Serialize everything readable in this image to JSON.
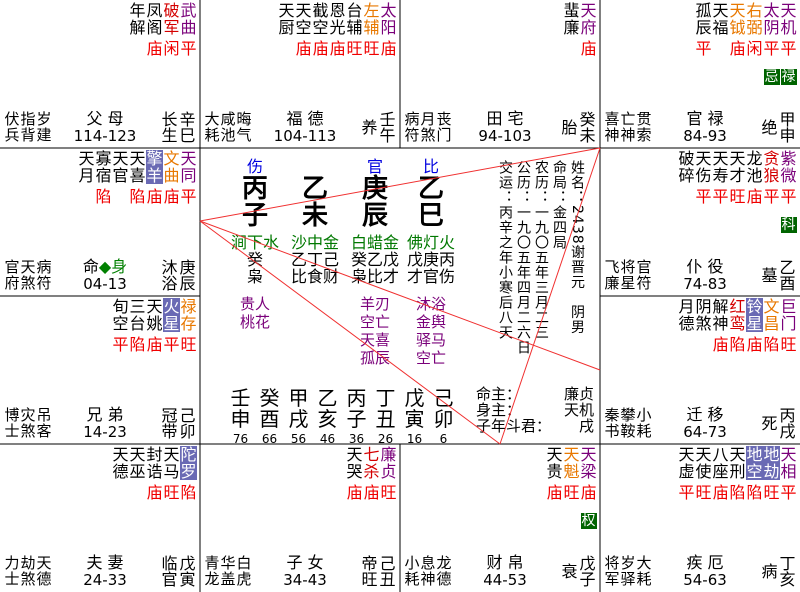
{
  "app_title": "紫微斗数命盘",
  "colors": {
    "major_star": "#7a007a",
    "red_star": "#d40000",
    "lucky_star": "#e87800",
    "malefic_badge_bg": "#6a6ab4",
    "transform_badge_bg": "#006400",
    "brightness": "#f00000",
    "nayin_green": "#007800",
    "ten_god_blue": "#0000e0",
    "note_purple": "#7a007a",
    "sanfang_line": "#f03030"
  },
  "palaces": [
    {
      "x": 0,
      "y": 0,
      "stars": [
        {
          "t": "年解",
          "c": "k",
          "s": "",
          "g": ""
        },
        {
          "t": "凤阁",
          "c": "k",
          "s": "庙",
          "g": ""
        },
        {
          "t": "破军",
          "c": "r",
          "s": "闲",
          "g": ""
        },
        {
          "t": "武曲",
          "c": "p",
          "s": "平",
          "g": ""
        }
      ],
      "petty": [
        "伏兵",
        "指背",
        "岁建"
      ],
      "palace": "父 母",
      "range": "114-123",
      "stage": "长生",
      "gz": "辛巳"
    },
    {
      "x": 200,
      "y": 0,
      "stars": [
        {
          "t": "天厨",
          "c": "k",
          "s": "",
          "g": ""
        },
        {
          "t": "天空",
          "c": "k",
          "s": "庙",
          "g": ""
        },
        {
          "t": "截空",
          "c": "k",
          "s": "庙",
          "g": ""
        },
        {
          "t": "恩光",
          "c": "k",
          "s": "庙",
          "g": ""
        },
        {
          "t": "台辅",
          "c": "k",
          "s": "旺",
          "g": ""
        },
        {
          "t": "左辅",
          "c": "o",
          "s": "旺",
          "g": ""
        },
        {
          "t": "太阳",
          "c": "p",
          "s": "庙",
          "g": ""
        }
      ],
      "petty": [
        "大耗",
        "咸池",
        "晦气"
      ],
      "palace": "福 德",
      "range": "104-113",
      "stage": "养",
      "gz": "壬午"
    },
    {
      "x": 400,
      "y": 0,
      "stars": [
        {
          "t": "蜚廉",
          "c": "k",
          "s": "",
          "g": ""
        },
        {
          "t": "天府",
          "c": "p",
          "s": "庙",
          "g": ""
        }
      ],
      "petty": [
        "病符",
        "月煞",
        "丧门"
      ],
      "palace": "田 宅",
      "range": "94-103",
      "stage": "胎",
      "gz": "癸未"
    },
    {
      "x": 600,
      "y": 0,
      "stars": [
        {
          "t": "孤辰",
          "c": "k",
          "s": "平",
          "g": ""
        },
        {
          "t": "天福",
          "c": "k",
          "s": "",
          "g": ""
        },
        {
          "t": "天钺",
          "c": "o",
          "s": "庙",
          "g": ""
        },
        {
          "t": "右弼",
          "c": "o",
          "s": "闲",
          "g": ""
        },
        {
          "t": "太阴",
          "c": "p",
          "s": "平",
          "g": "忌"
        },
        {
          "t": "天机",
          "c": "p",
          "s": "平",
          "g": "禄"
        }
      ],
      "petty": [
        "喜神",
        "亡神",
        "贯索"
      ],
      "palace": "官 禄",
      "range": "84-93",
      "stage": "绝",
      "gz": "甲申"
    },
    {
      "x": 0,
      "y": 148,
      "stars": [
        {
          "t": "天月",
          "c": "k",
          "s": "",
          "g": ""
        },
        {
          "t": "寡宿",
          "c": "k",
          "s": "陷",
          "g": ""
        },
        {
          "t": "天官",
          "c": "k",
          "s": "",
          "g": ""
        },
        {
          "t": "天喜",
          "c": "k",
          "s": "陷",
          "g": ""
        },
        {
          "t": "擎羊",
          "c": "b",
          "s": "庙",
          "g": ""
        },
        {
          "t": "文曲",
          "c": "o",
          "s": "庙",
          "g": ""
        },
        {
          "t": "天同",
          "c": "p",
          "s": "平",
          "g": ""
        }
      ],
      "petty": [
        "官府",
        "天煞",
        "病符"
      ],
      "palace": "命◆身",
      "palace_parts": [
        {
          "t": "命",
          "grn": false
        },
        {
          "t": "◆身",
          "grn": true
        }
      ],
      "range": "04-13",
      "stage": "沐浴",
      "gz": "庚辰"
    },
    {
      "x": 600,
      "y": 148,
      "stars": [
        {
          "t": "破碎",
          "c": "k",
          "s": "",
          "g": ""
        },
        {
          "t": "天伤",
          "c": "k",
          "s": "平",
          "g": ""
        },
        {
          "t": "天寿",
          "c": "k",
          "s": "平",
          "g": ""
        },
        {
          "t": "天才",
          "c": "k",
          "s": "旺",
          "g": ""
        },
        {
          "t": "龙池",
          "c": "k",
          "s": "庙",
          "g": ""
        },
        {
          "t": "贪狼",
          "c": "r",
          "s": "平",
          "g": ""
        },
        {
          "t": "紫微",
          "c": "p",
          "s": "平",
          "g": "科"
        }
      ],
      "petty": [
        "飞廉",
        "将星",
        "官符"
      ],
      "palace": "仆 役",
      "range": "74-83",
      "stage": "墓",
      "gz": "乙酉"
    },
    {
      "x": 0,
      "y": 296,
      "stars": [
        {
          "t": "旬空",
          "c": "k",
          "s": "平",
          "g": ""
        },
        {
          "t": "三台",
          "c": "k",
          "s": "陷",
          "g": ""
        },
        {
          "t": "天姚",
          "c": "k",
          "s": "庙",
          "g": ""
        },
        {
          "t": "火星",
          "c": "b",
          "s": "平",
          "g": ""
        },
        {
          "t": "禄存",
          "c": "o",
          "s": "旺",
          "g": ""
        }
      ],
      "petty": [
        "博士",
        "灾煞",
        "吊客"
      ],
      "palace": "兄 弟",
      "range": "14-23",
      "stage": "冠带",
      "gz": "己卯"
    },
    {
      "x": 600,
      "y": 296,
      "stars": [
        {
          "t": "月德",
          "c": "k",
          "s": "",
          "g": ""
        },
        {
          "t": "阴煞",
          "c": "k",
          "s": "",
          "g": ""
        },
        {
          "t": "解神",
          "c": "k",
          "s": "庙",
          "g": ""
        },
        {
          "t": "红鸾",
          "c": "r",
          "s": "陷",
          "g": ""
        },
        {
          "t": "铃星",
          "c": "b",
          "s": "庙",
          "g": ""
        },
        {
          "t": "文昌",
          "c": "o",
          "s": "陷",
          "g": ""
        },
        {
          "t": "巨门",
          "c": "p",
          "s": "旺",
          "g": ""
        }
      ],
      "petty": [
        "秦书",
        "攀鞍",
        "小耗"
      ],
      "palace": "迁 移",
      "range": "64-73",
      "stage": "死",
      "gz": "丙戌"
    },
    {
      "x": 0,
      "y": 444,
      "stars": [
        {
          "t": "天德",
          "c": "k",
          "s": "",
          "g": ""
        },
        {
          "t": "天巫",
          "c": "k",
          "s": "",
          "g": ""
        },
        {
          "t": "封诰",
          "c": "k",
          "s": "庙",
          "g": ""
        },
        {
          "t": "天马",
          "c": "k",
          "s": "旺",
          "g": ""
        },
        {
          "t": "陀罗",
          "c": "b",
          "s": "陷",
          "g": ""
        }
      ],
      "petty": [
        "力士",
        "劫煞",
        "天德"
      ],
      "palace": "夫 妻",
      "range": "24-33",
      "stage": "临官",
      "gz": "戊寅"
    },
    {
      "x": 200,
      "y": 444,
      "stars": [
        {
          "t": "天哭",
          "c": "k",
          "s": "庙",
          "g": ""
        },
        {
          "t": "七杀",
          "c": "r",
          "s": "庙",
          "g": ""
        },
        {
          "t": "廉贞",
          "c": "p",
          "s": "旺",
          "g": ""
        }
      ],
      "petty": [
        "青龙",
        "华盖",
        "白虎"
      ],
      "palace": "子 女",
      "range": "34-43",
      "stage": "帝旺",
      "gz": "己丑"
    },
    {
      "x": 400,
      "y": 444,
      "stars": [
        {
          "t": "天贵",
          "c": "k",
          "s": "庙",
          "g": ""
        },
        {
          "t": "天魁",
          "c": "o",
          "s": "旺",
          "g": ""
        },
        {
          "t": "天梁",
          "c": "p",
          "s": "庙",
          "g": "权"
        }
      ],
      "petty": [
        "小耗",
        "息神",
        "龙德"
      ],
      "palace": "财 帛",
      "range": "44-53",
      "stage": "衰",
      "gz": "戊子"
    },
    {
      "x": 600,
      "y": 444,
      "stars": [
        {
          "t": "天虚",
          "c": "k",
          "s": "平",
          "g": ""
        },
        {
          "t": "天使",
          "c": "k",
          "s": "旺",
          "g": ""
        },
        {
          "t": "八座",
          "c": "k",
          "s": "庙",
          "g": ""
        },
        {
          "t": "天刑",
          "c": "k",
          "s": "陷",
          "g": ""
        },
        {
          "t": "地空",
          "c": "b",
          "s": "陷",
          "g": ""
        },
        {
          "t": "地劫",
          "c": "b",
          "s": "旺",
          "g": ""
        },
        {
          "t": "天相",
          "c": "p",
          "s": "平",
          "g": ""
        }
      ],
      "petty": [
        "将军",
        "岁驿",
        "大耗"
      ],
      "palace": "疾 厄",
      "range": "54-63",
      "stage": "病",
      "gz": "丁亥"
    }
  ],
  "center": {
    "pillars": [
      {
        "god": "伤",
        "gan": "丙",
        "zhi": "子",
        "nayin": "涧下水",
        "hidden": "癸",
        "hgods": "枭",
        "notes": [
          "贵人",
          "桃花"
        ]
      },
      {
        "god": "",
        "gan": "乙",
        "zhi": "未",
        "nayin": "沙中金",
        "hidden": "乙丁己",
        "hgods": "比食财",
        "notes": []
      },
      {
        "god": "官",
        "gan": "庚",
        "zhi": "辰",
        "nayin": "白蜡金",
        "hidden": "癸乙戊",
        "hgods": "枭比才",
        "notes": [
          "羊刃",
          "空亡",
          "天喜",
          "孤辰"
        ]
      },
      {
        "god": "比",
        "gan": "乙",
        "zhi": "巳",
        "nayin": "佛灯火",
        "hidden": "戊庚丙",
        "hgods": "才官伤",
        "notes": [
          "沐浴",
          "金舆",
          "驿马",
          "空亡"
        ]
      }
    ],
    "dayun": [
      {
        "gz": "壬申",
        "age": "76"
      },
      {
        "gz": "癸酉",
        "age": "66"
      },
      {
        "gz": "甲戌",
        "age": "56"
      },
      {
        "gz": "乙亥",
        "age": "46"
      },
      {
        "gz": "丙子",
        "age": "36"
      },
      {
        "gz": "丁丑",
        "age": "26"
      },
      {
        "gz": "戊寅",
        "age": "16"
      },
      {
        "gz": "己卯",
        "age": "6"
      }
    ],
    "info": [
      {
        "label": "交运",
        "value": "丙辛之年小寒后八天"
      },
      {
        "label": "公历",
        "value": "一九〇五年四月二六日"
      },
      {
        "label": "农历",
        "value": "一九〇五年三月二三"
      },
      {
        "label": "命局",
        "value": "金四局"
      },
      {
        "label": "姓名",
        "value": "2438谢晋元　阴男"
      }
    ],
    "masters": [
      {
        "label": "命主：",
        "value": "廉贞"
      },
      {
        "label": "身主：",
        "value": "天机"
      },
      {
        "label": "子年斗君：",
        "value": "戌"
      }
    ]
  },
  "grid_lines": [
    [
      200,
      0,
      200,
      592
    ],
    [
      600,
      0,
      600,
      592
    ],
    [
      400,
      0,
      400,
      148
    ],
    [
      400,
      444,
      400,
      592
    ],
    [
      0,
      148,
      800,
      148
    ],
    [
      0,
      444,
      800,
      444
    ],
    [
      0,
      296,
      200,
      296
    ],
    [
      600,
      296,
      800,
      296
    ]
  ],
  "sanfang_lines": [
    [
      200,
      221,
      600,
      148
    ],
    [
      200,
      221,
      600,
      370
    ],
    [
      200,
      221,
      500,
      444
    ],
    [
      600,
      148,
      500,
      444
    ]
  ]
}
